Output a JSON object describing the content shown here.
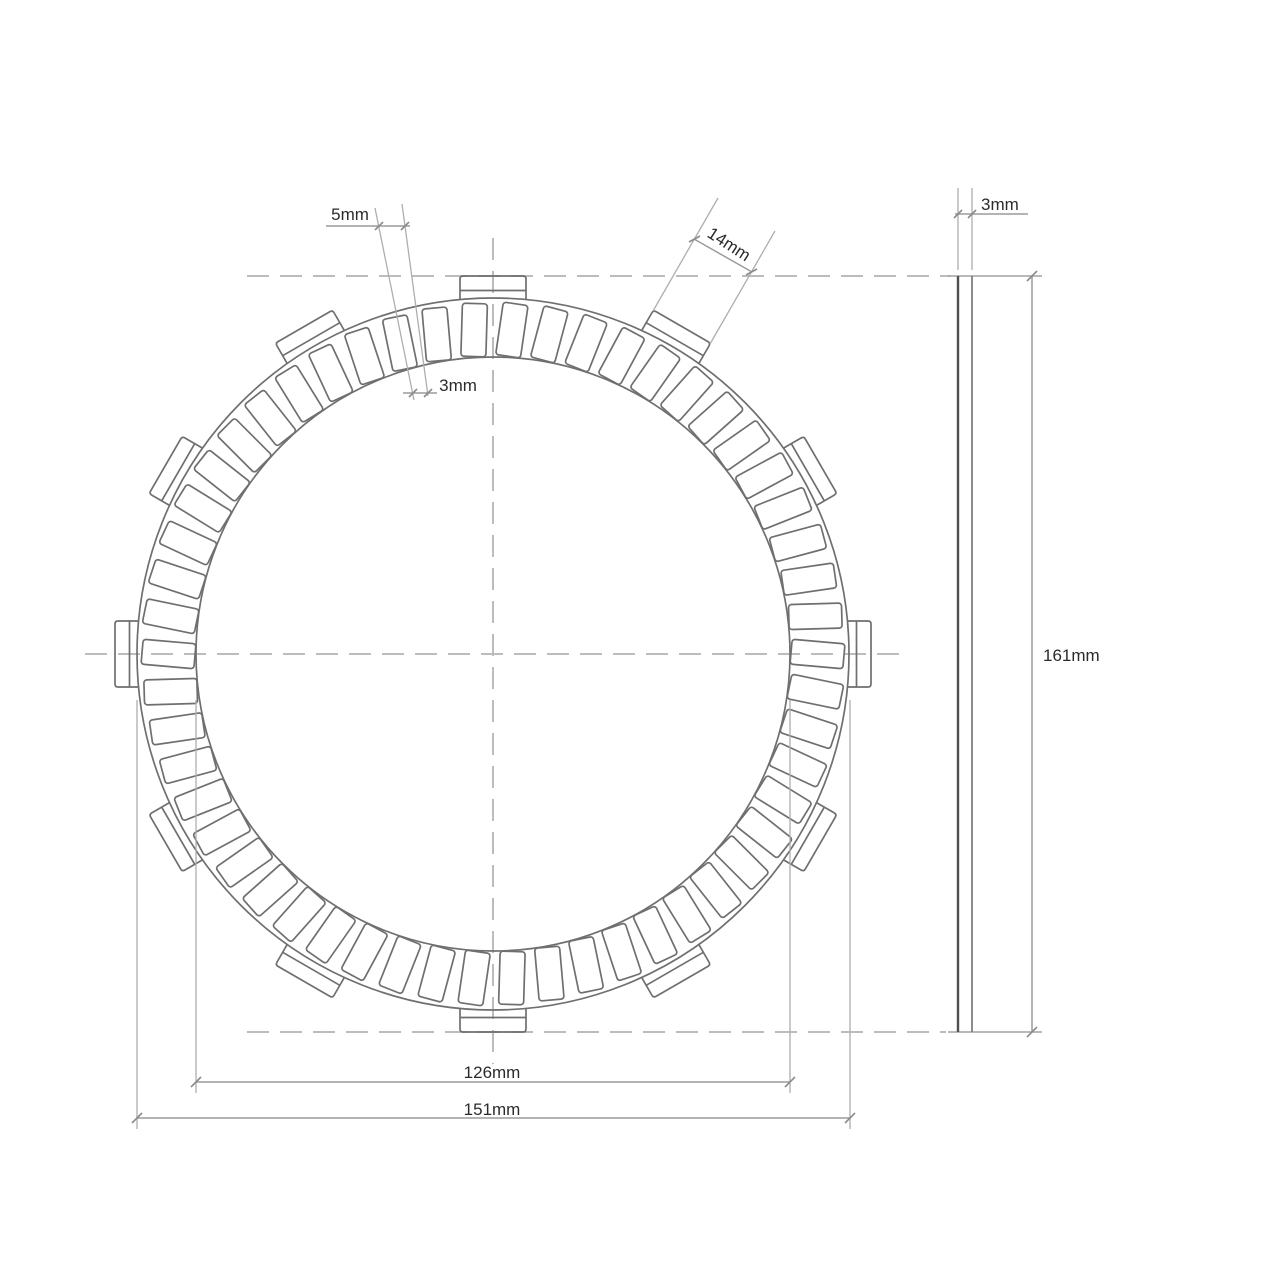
{
  "page": {
    "background": "#ffffff"
  },
  "colors": {
    "part_line": "#6f6f6f",
    "centerline": "#bcbcbc",
    "extension_line": "#aeaeae",
    "dimension_line": "#9b9b9b",
    "tick": "#8b8b8b",
    "side_view_left_edge": "#4f4f4f",
    "side_view_right_edge": "#7f7f7f",
    "side_view_cap": "#a2a2a2",
    "label_text": "#2b2b2b"
  },
  "drawing": {
    "kind": "clutch-friction-disc-technical-drawing",
    "front_view": {
      "center": {
        "x": 493,
        "y": 654
      },
      "outer_circle_radius": 356,
      "inner_circle_radius": 297,
      "tabs": {
        "count": 12,
        "angle_step_deg": 30,
        "first_angle_deg": 0,
        "half_width": 33,
        "base_radius": 354,
        "tip_radius": 378,
        "step_line_radius": 363.5,
        "tip_corner_radius": 3
      },
      "pads": {
        "count": 54,
        "angle_step_deg": 6.6667,
        "first_angle_deg": 3.3333,
        "width": 25,
        "outer_radius": 351,
        "inner_radius": 298,
        "slant_deg": 5,
        "corner_radius": 3
      }
    },
    "centerlines": [
      {
        "x1": 85,
        "y1": 654,
        "x2": 908,
        "y2": 654
      },
      {
        "x1": 493,
        "y1": 238,
        "x2": 493,
        "y2": 1064
      },
      {
        "x1": 247,
        "y1": 276,
        "x2": 950,
        "y2": 276
      },
      {
        "x1": 247,
        "y1": 1032,
        "x2": 946,
        "y2": 1032
      }
    ],
    "side_view": {
      "left_edge": {
        "x1": 958,
        "y1": 276,
        "x2": 958,
        "y2": 1032
      },
      "right_edge": {
        "x1": 972,
        "y1": 276,
        "x2": 972,
        "y2": 1032
      },
      "top_cap": {
        "x1": 948,
        "y1": 276,
        "x2": 1042,
        "y2": 276
      },
      "bottom_cap": {
        "x1": 948,
        "y1": 1032,
        "x2": 1042,
        "y2": 1032
      }
    }
  },
  "dimensions": [
    {
      "id": "pad-groove-outer-width",
      "label": "5mm",
      "ext": [
        [
          375,
          208,
          414,
          400
        ],
        [
          402,
          204,
          428,
          396
        ]
      ],
      "dim": [
        [
          326,
          226,
          410,
          226
        ]
      ],
      "ticks": [
        [
          375,
          230,
          383,
          222
        ],
        [
          401,
          230,
          409,
          222
        ]
      ],
      "text": {
        "x": 350,
        "y": 220,
        "anchor": "middle",
        "rotate": 0
      }
    },
    {
      "id": "pad-groove-inner-width",
      "label": "3mm",
      "ext": [],
      "dim": [
        [
          403,
          393,
          437,
          393
        ]
      ],
      "ticks": [
        [
          409,
          397,
          417,
          389
        ],
        [
          424,
          397,
          432,
          389
        ]
      ],
      "text": {
        "x": 458,
        "y": 391,
        "anchor": "middle",
        "rotate": 0
      }
    },
    {
      "id": "tab-width",
      "label": "14mm",
      "ext": [
        [
          653,
          311,
          718,
          198
        ],
        [
          710,
          344,
          775,
          231
        ]
      ],
      "dim": [
        [
          694,
          239,
          752,
          272
        ]
      ],
      "ticks": [
        [
          689,
          242,
          700,
          236
        ],
        [
          746,
          275,
          757,
          269
        ]
      ],
      "text": {
        "x": 726,
        "y": 249,
        "anchor": "middle",
        "rotate": 33
      }
    },
    {
      "id": "plate-thickness",
      "label": "3mm",
      "ext": [
        [
          958,
          270,
          958,
          188
        ],
        [
          972,
          270,
          972,
          188
        ]
      ],
      "dim": [
        [
          955,
          214,
          1028,
          214
        ]
      ],
      "ticks": [
        [
          954,
          218,
          962,
          210
        ],
        [
          968,
          218,
          976,
          210
        ]
      ],
      "text": {
        "x": 981,
        "y": 210,
        "anchor": "start",
        "rotate": 0
      }
    },
    {
      "id": "overall-diameter",
      "label": "161mm",
      "ext": [],
      "dim": [
        [
          1032,
          276,
          1032,
          1032
        ]
      ],
      "ticks": [
        [
          1027,
          281,
          1037,
          271
        ],
        [
          1027,
          1037,
          1037,
          1027
        ]
      ],
      "text": {
        "x": 1043,
        "y": 661,
        "anchor": "start",
        "rotate": 0
      }
    },
    {
      "id": "friction-inner-diameter",
      "label": "126mm",
      "ext": [
        [
          196,
          700,
          196,
          1093
        ],
        [
          790,
          700,
          790,
          1093
        ]
      ],
      "dim": [
        [
          196,
          1082,
          790,
          1082
        ]
      ],
      "ticks": [
        [
          191,
          1087,
          201,
          1077
        ],
        [
          785,
          1087,
          795,
          1077
        ]
      ],
      "text": {
        "x": 492,
        "y": 1078,
        "anchor": "middle",
        "rotate": 0
      }
    },
    {
      "id": "outer-diameter",
      "label": "151mm",
      "ext": [
        [
          137,
          700,
          137,
          1129
        ],
        [
          850,
          700,
          850,
          1129
        ]
      ],
      "dim": [
        [
          137,
          1118,
          850,
          1118
        ]
      ],
      "ticks": [
        [
          132,
          1123,
          142,
          1113
        ],
        [
          845,
          1123,
          855,
          1113
        ]
      ],
      "text": {
        "x": 492,
        "y": 1115,
        "anchor": "middle",
        "rotate": 0
      }
    }
  ]
}
